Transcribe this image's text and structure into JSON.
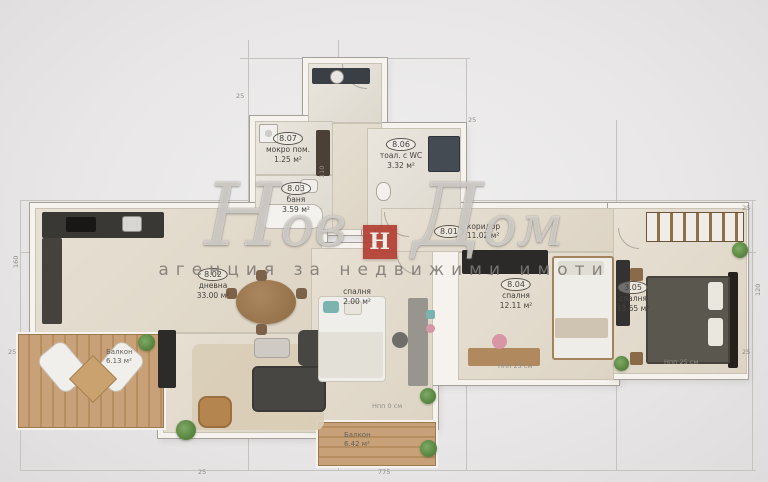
{
  "watermark": {
    "word1": "Нов",
    "word2": "Дом",
    "logo_letter": "Н",
    "subtitle": "агенция за недвижими имоти"
  },
  "rooms": {
    "storage": {
      "number": "8.07",
      "name": "мокро пом.",
      "area": "1.25 м²"
    },
    "bath": {
      "number": "8.03",
      "name": "баня",
      "area": "3.59 м²"
    },
    "wc": {
      "number": "8.06",
      "name": "тоал. с WC",
      "area": "3.32 м²"
    },
    "hallway": {
      "number": "8.01",
      "name": "коридор",
      "area": "11.02 м²"
    },
    "living": {
      "number": "8.02",
      "name": "дневна",
      "area": "33.00 м²"
    },
    "bedroom_mid": {
      "name": "спалня",
      "area": "2.00 м²"
    },
    "bedroom2": {
      "number": "8.04",
      "name": "спалня",
      "area": "12.11 м²"
    },
    "bedroom3": {
      "number": "3.05",
      "name": "спалня",
      "area": "13.65 м²"
    },
    "balcony_left": {
      "name": "Балкон",
      "area": "6.13 м²"
    },
    "balcony_bottom": {
      "name": "Балкон",
      "area": "6.42 м²"
    }
  },
  "annotations": {
    "parapet1": "Нпп 25 см",
    "parapet2": "Нпп 25 см",
    "parapet3": "Нпп 0 см"
  },
  "dimensions": {
    "t1": "25",
    "t2": "110",
    "t3": "25",
    "r1": "25",
    "r2": "120",
    "r3": "25",
    "b1": "775",
    "b2": "25",
    "l1": "160",
    "l2": "25"
  },
  "colors": {
    "background": "#eae8e8",
    "wall": "#f6f3ee",
    "floor": "#e2dbce",
    "balcony_wood": "#c8a178",
    "dark_furniture": "#35332f",
    "logo_red": "#b23b2f",
    "teal_accent": "#7bb3ae",
    "plant_green": "#5c8a43"
  }
}
